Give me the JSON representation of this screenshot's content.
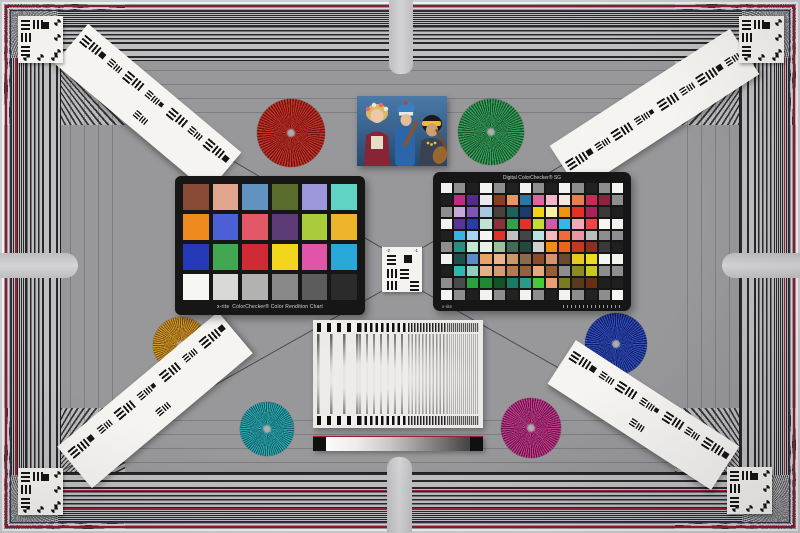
{
  "chart": {
    "description": "photographed multi-purpose camera test chart",
    "background_color": "#98989b",
    "accent_red": "#8e1a2e",
    "tab_color": "#c9c9cc"
  },
  "colorchecker_classic": {
    "brand": "x-rite",
    "caption": "ColorChecker® Color Rendition Chart",
    "rows": 4,
    "cols": 6,
    "patches": [
      "#8a4a38",
      "#e0a58c",
      "#6292c0",
      "#5a6c2c",
      "#9b97da",
      "#60d4c4",
      "#ee8a1c",
      "#4a60d4",
      "#e25866",
      "#5c3a76",
      "#a8cc3c",
      "#eeb42a",
      "#2438b8",
      "#42a652",
      "#d02a34",
      "#f2d61e",
      "#e055a8",
      "#28a8d8",
      "#f6f6f3",
      "#d9d9d6",
      "#b2b2b0",
      "#898989",
      "#5c5c5c",
      "#2b2b2b"
    ]
  },
  "colorchecker_sg": {
    "brand": "x-rite",
    "title": "Digital ColorChecker® SG",
    "rows": 10,
    "cols": 14,
    "patches": [
      [
        "#f2f2ee",
        "#8e8e8e",
        "#1f1f1f",
        "#f4f4f0",
        "#8e8e8e",
        "#222222",
        "#f2f2ee",
        "#8e8e8e",
        "#1f1f1f",
        "#f2f2ee",
        "#8e8e8e",
        "#222222",
        "#8e8e8e",
        "#f4f4f0"
      ],
      [
        "#1f1f1f",
        "#bc2d80",
        "#512b92",
        "#eae9ee",
        "#8a3d20",
        "#ea965e",
        "#2a76a8",
        "#e4639a",
        "#f2b6ca",
        "#f8e4e0",
        "#ea7c50",
        "#c62a55",
        "#8c2440",
        "#8e8e8e"
      ],
      [
        "#8e8e8e",
        "#c9a8d8",
        "#7e55b2",
        "#a8c8e2",
        "#46443a",
        "#20615c",
        "#1d3a70",
        "#eed319",
        "#f8f2a8",
        "#f09313",
        "#e23227",
        "#a62458",
        "#3a3a3a",
        "#1f1f1f"
      ],
      [
        "#f2f2ee",
        "#5e3099",
        "#2b3da4",
        "#bfe3d2",
        "#8e2d3c",
        "#32a14c",
        "#e2302a",
        "#c6da35",
        "#d857a4",
        "#35b6e6",
        "#f2aab8",
        "#e84848",
        "#f4f4f0",
        "#f2f2ee"
      ],
      [
        "#1f1f1f",
        "#38b4e4",
        "#a8d6f2",
        "#f4f4f0",
        "#e0302c",
        "#c0c0c0",
        "#454545",
        "#b6e4e4",
        "#f2babe",
        "#f06a3a",
        "#e995a4",
        "#bcbcbc",
        "#8e8e8e",
        "#8e8e8e"
      ],
      [
        "#8e8e8e",
        "#2a8d80",
        "#c2e8d4",
        "#e9f0e4",
        "#9ac29a",
        "#3c6e58",
        "#1e4a40",
        "#d0d0ce",
        "#f08d12",
        "#e8651e",
        "#c23a22",
        "#8c2f20",
        "#3a3a3a",
        "#1f1f1f"
      ],
      [
        "#f2f2ee",
        "#1d4f48",
        "#5a8cc8",
        "#e8a468",
        "#eab48e",
        "#c89a6a",
        "#8a6a4a",
        "#8a4c28",
        "#d8936c",
        "#6a4a32",
        "#e8c81c",
        "#f0da22",
        "#f4f4f0",
        "#f2f2ee"
      ],
      [
        "#1f1f1f",
        "#30b8ac",
        "#88d0c0",
        "#e8b088",
        "#d89a70",
        "#b87848",
        "#986038",
        "#e8a878",
        "#9a5c30",
        "#8e8e8e",
        "#8a8c20",
        "#c8c822",
        "#8e8e8e",
        "#8e8e8e"
      ],
      [
        "#8e8e8e",
        "#4a4a4a",
        "#2aa23c",
        "#1e8a34",
        "#14532a",
        "#1b7a66",
        "#2a9a8a",
        "#4ac83c",
        "#e8a070",
        "#7a7a20",
        "#5a3a1a",
        "#6a2e12",
        "#1f1f1f",
        "#1f1f1f"
      ],
      [
        "#f4f4f0",
        "#8e8e8e",
        "#1f1f1f",
        "#f2f2ee",
        "#8e8e8e",
        "#222222",
        "#f2f2ee",
        "#8e8e8e",
        "#1f1f1f",
        "#f2f2ee",
        "#8e8e8e",
        "#222222",
        "#8e8e8e",
        "#f4f4f0"
      ]
    ]
  },
  "siemens_stars": [
    {
      "name": "red",
      "cx": 291,
      "cy": 133,
      "r": 34,
      "color_a": "#c8342a",
      "color_b": "#6e1410"
    },
    {
      "name": "green",
      "cx": 491,
      "cy": 132,
      "r": 33,
      "color_a": "#3aa05c",
      "color_b": "#14532a"
    },
    {
      "name": "gold",
      "cx": 181,
      "cy": 345,
      "r": 28,
      "color_a": "#d49a2e",
      "color_b": "#7a5210"
    },
    {
      "name": "teal",
      "cx": 267,
      "cy": 429,
      "r": 27,
      "color_a": "#32aab4",
      "color_b": "#0e5e66"
    },
    {
      "name": "blue",
      "cx": 616,
      "cy": 344,
      "r": 31,
      "color_a": "#3450c0",
      "color_b": "#101e64"
    },
    {
      "name": "magenta",
      "cx": 531,
      "cy": 428,
      "r": 30,
      "color_a": "#c2418f",
      "color_b": "#6e1048"
    }
  ],
  "resolution_strips": [
    {
      "id": "top-left",
      "cx": 148,
      "cy": 108,
      "len": 200,
      "w": 52,
      "angle": 40
    },
    {
      "id": "top-right",
      "cx": 654,
      "cy": 110,
      "len": 215,
      "w": 54,
      "angle": -33
    },
    {
      "id": "bottom-left",
      "cx": 155,
      "cy": 400,
      "len": 210,
      "w": 54,
      "angle": -40
    },
    {
      "id": "bottom-right",
      "cx": 643,
      "cy": 415,
      "len": 195,
      "w": 52,
      "angle": 33
    }
  ],
  "corner_targets": [
    {
      "id": "top-left",
      "x": 18,
      "y": 16
    },
    {
      "id": "top-right",
      "x": 739,
      "y": 16
    },
    {
      "id": "bottom-left",
      "x": 18,
      "y": 468
    },
    {
      "id": "bottom-right",
      "x": 727,
      "y": 467
    }
  ],
  "center_target": {
    "label_left": "-2",
    "label_right": "-1"
  },
  "photo": {
    "description": "three costumed musicians with string instruments on blue background"
  }
}
